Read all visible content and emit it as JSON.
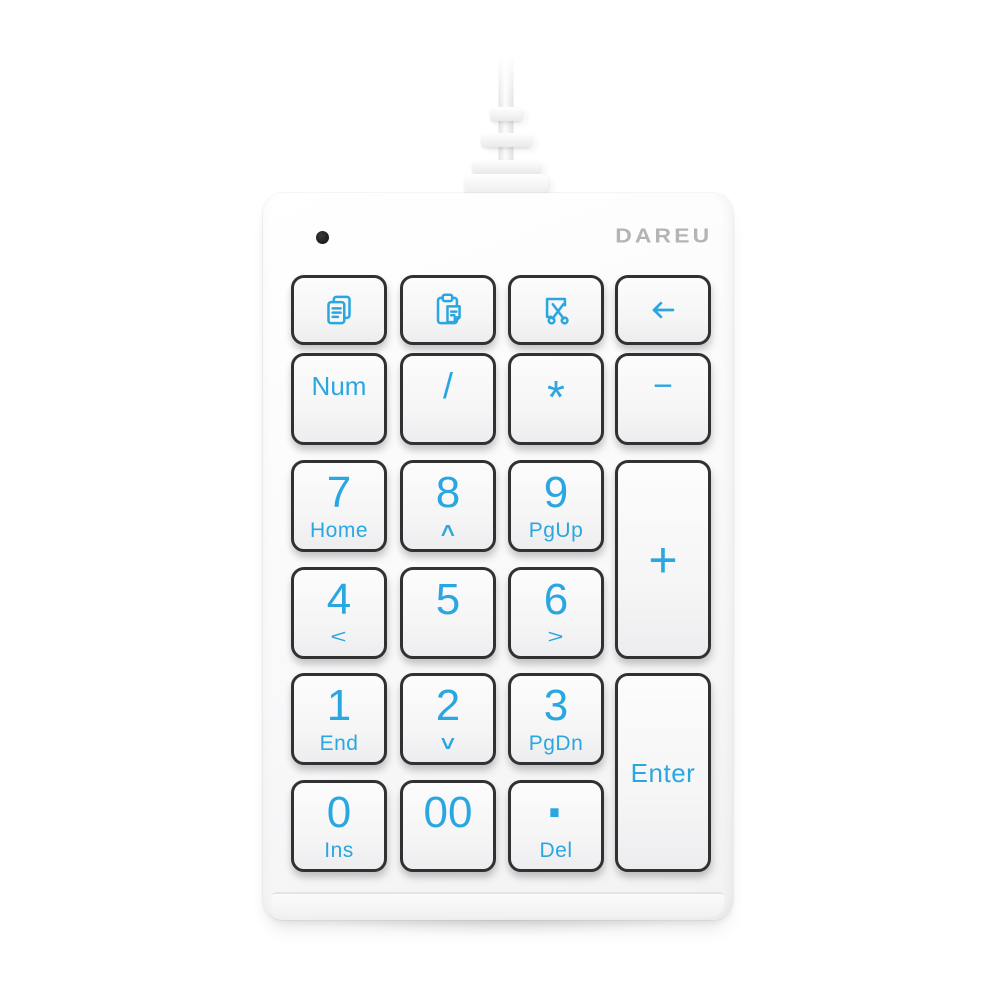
{
  "logo": {
    "text": "DAREU",
    "color": "#b4b4b4"
  },
  "indicator": {
    "type": "status-led",
    "color": "#1c1c1c"
  },
  "colors": {
    "legend": "#2aa7e0",
    "key_outline": "#313134",
    "key_face": "#f8f8f9",
    "body": "#f8f8f9",
    "background": "#ffffff"
  },
  "keypad": {
    "keys": [
      {
        "id": "copy",
        "icon": "copy-icon",
        "col": 1,
        "row": 1
      },
      {
        "id": "paste",
        "icon": "paste-icon",
        "col": 2,
        "row": 1
      },
      {
        "id": "cut",
        "icon": "cut-icon",
        "col": 3,
        "row": 1
      },
      {
        "id": "backspace",
        "icon": "backspace-icon",
        "col": 4,
        "row": 1
      },
      {
        "id": "num-lock",
        "label": "Num",
        "col": 1,
        "row": 2
      },
      {
        "id": "divide",
        "label": "/",
        "col": 2,
        "row": 2
      },
      {
        "id": "multiply",
        "label": "*",
        "col": 3,
        "row": 2
      },
      {
        "id": "minus",
        "label": "−",
        "col": 4,
        "row": 2
      },
      {
        "id": "7",
        "label": "7",
        "sub": "Home",
        "col": 1,
        "row": 3
      },
      {
        "id": "8",
        "label": "8",
        "sub": "∧",
        "col": 2,
        "row": 3
      },
      {
        "id": "9",
        "label": "9",
        "sub": "PgUp",
        "col": 3,
        "row": 3
      },
      {
        "id": "plus",
        "label": "+",
        "col": 4,
        "row": 3,
        "rowspan": 2
      },
      {
        "id": "4",
        "label": "4",
        "sub": "<",
        "col": 1,
        "row": 4
      },
      {
        "id": "5",
        "label": "5",
        "col": 2,
        "row": 4
      },
      {
        "id": "6",
        "label": "6",
        "sub": ">",
        "col": 3,
        "row": 4
      },
      {
        "id": "1",
        "label": "1",
        "sub": "End",
        "col": 1,
        "row": 5
      },
      {
        "id": "2",
        "label": "2",
        "sub": "∨",
        "col": 2,
        "row": 5
      },
      {
        "id": "3",
        "label": "3",
        "sub": "PgDn",
        "col": 3,
        "row": 5
      },
      {
        "id": "enter",
        "label": "Enter",
        "col": 4,
        "row": 5,
        "rowspan": 2
      },
      {
        "id": "0",
        "label": "0",
        "sub": "Ins",
        "col": 1,
        "row": 6
      },
      {
        "id": "double-zero",
        "label": "00",
        "col": 2,
        "row": 6
      },
      {
        "id": "decimal",
        "label": "·",
        "sub": "Del",
        "col": 3,
        "row": 6
      }
    ]
  }
}
